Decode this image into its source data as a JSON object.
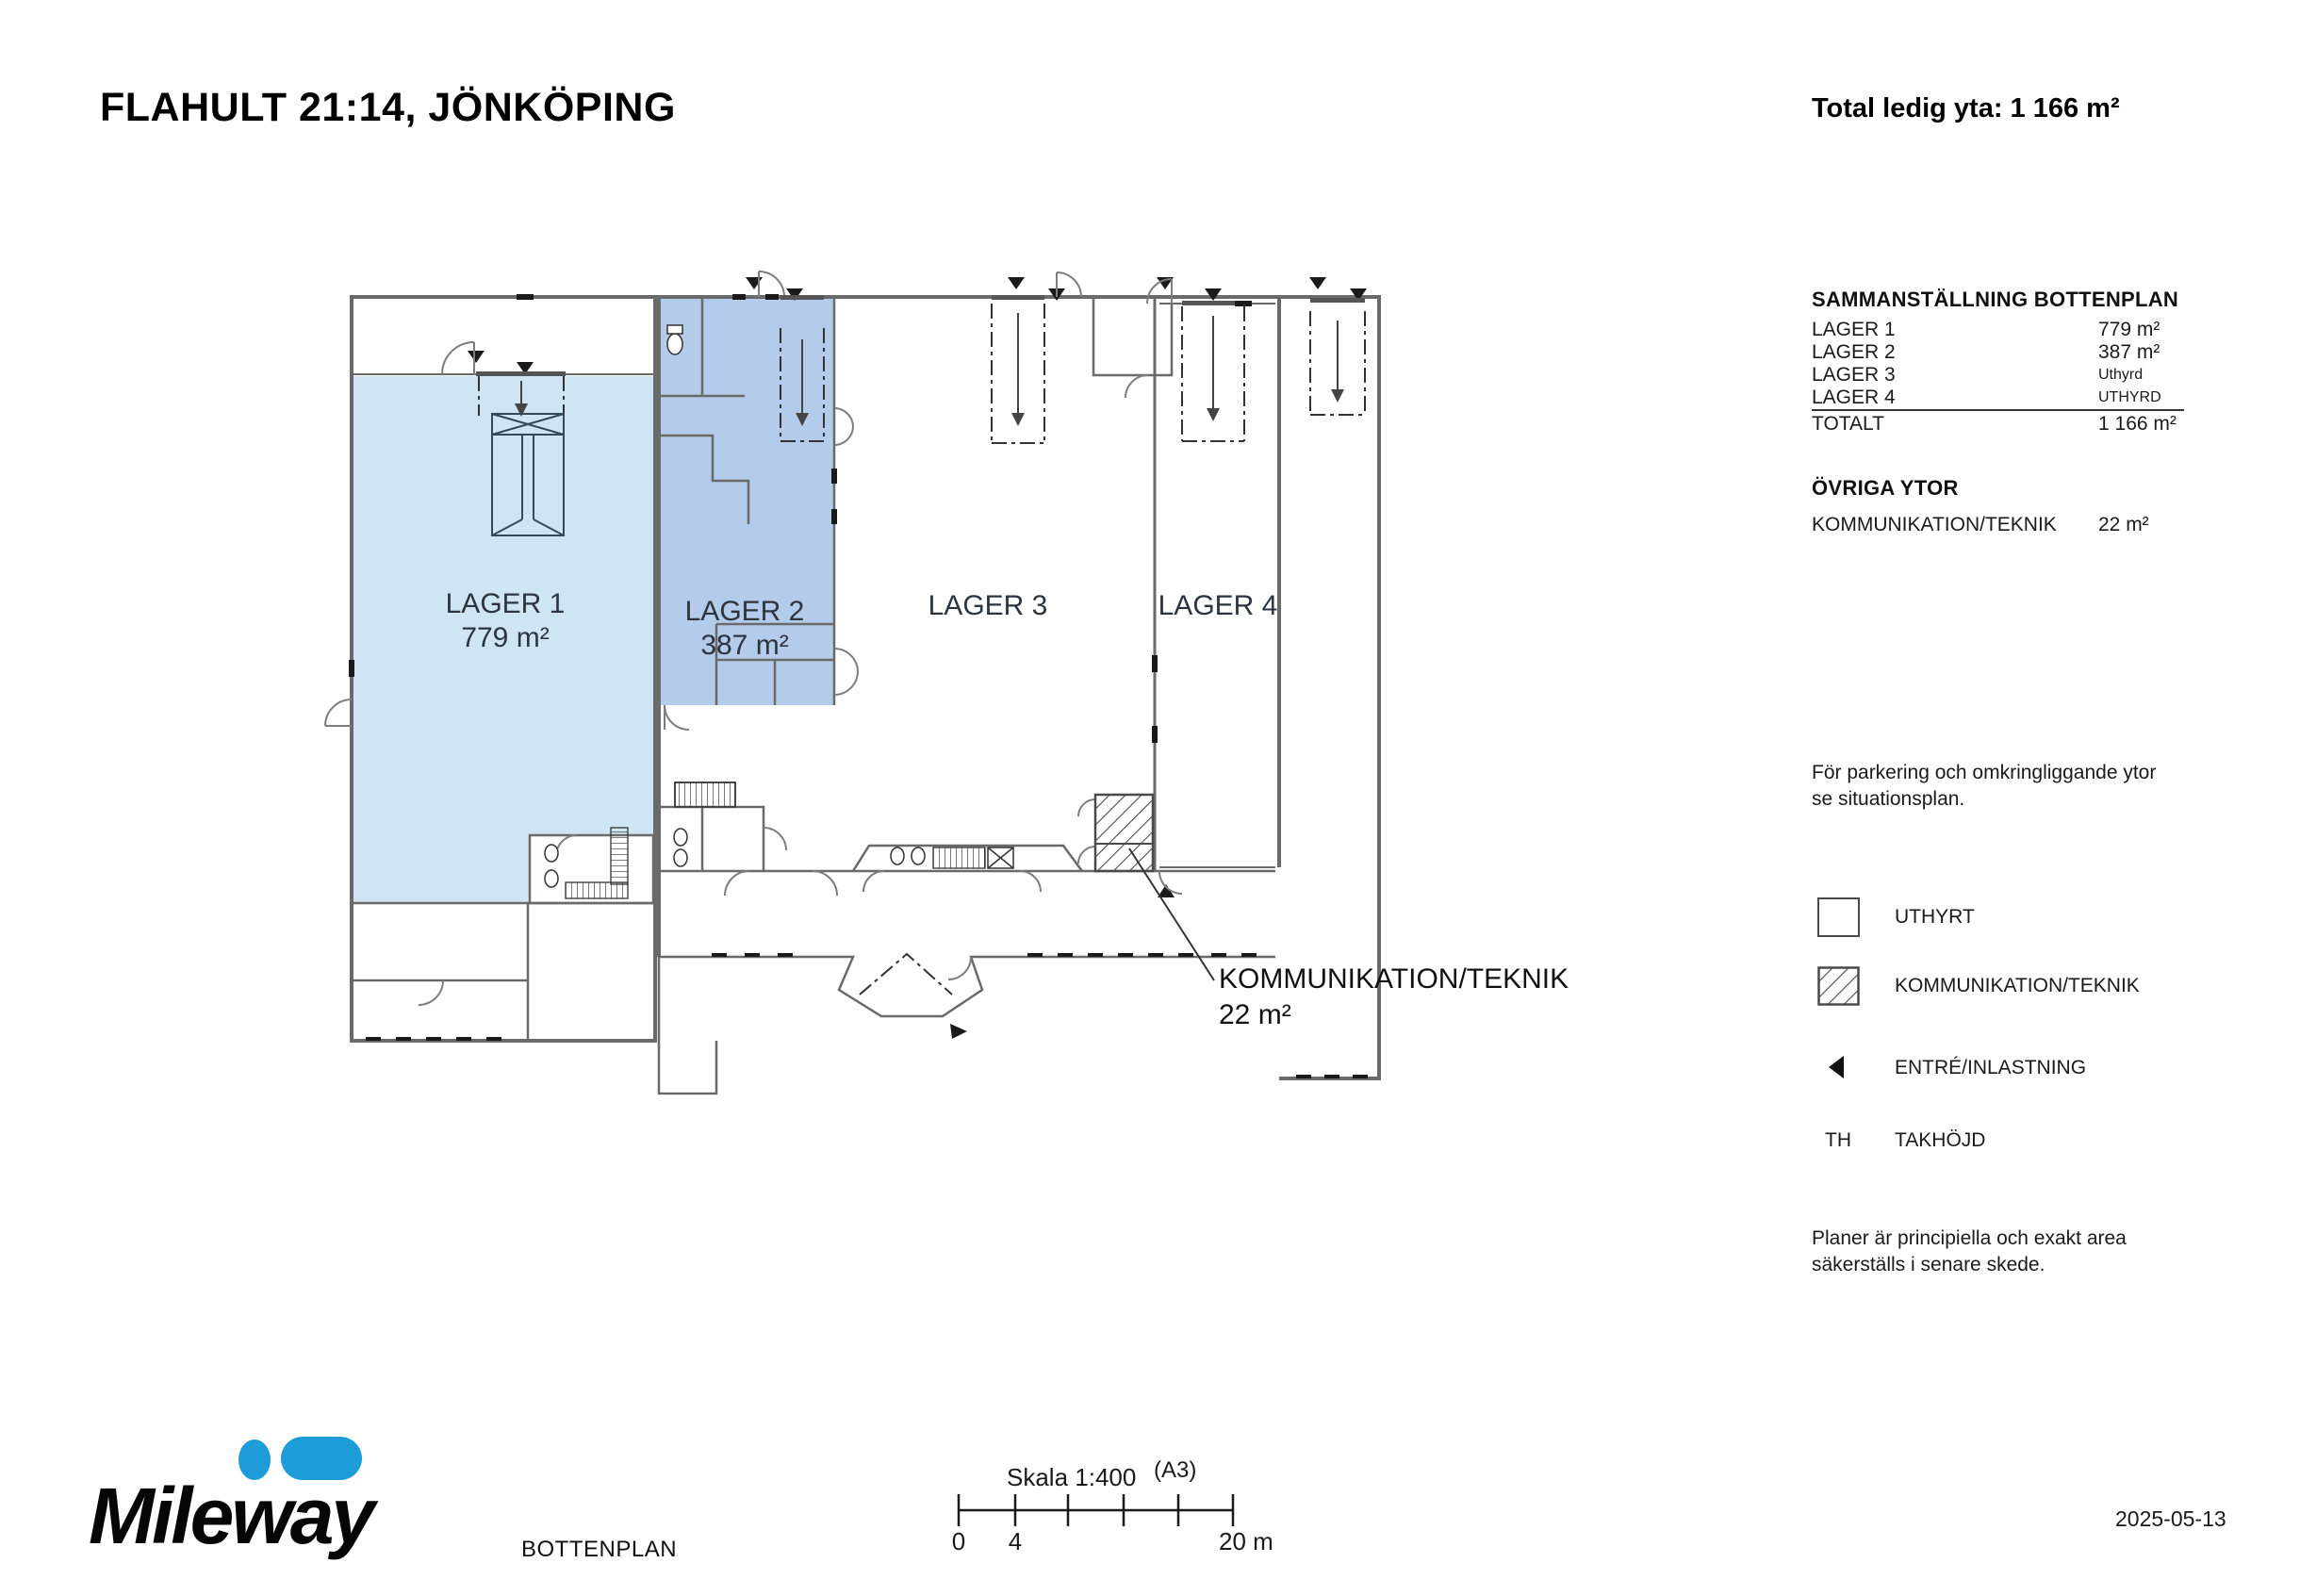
{
  "page": {
    "title": "FLAHULT 21:14, JÖNKÖPING",
    "total_area": "Total ledig yta: 1 166 m²",
    "date": "2025-05-13"
  },
  "summary": {
    "heading": "SAMMANSTÄLLNING BOTTENPLAN",
    "rows": [
      {
        "label": "LAGER 1",
        "value": "779 m²"
      },
      {
        "label": "LAGER 2",
        "value": "387 m²"
      },
      {
        "label": "LAGER 3",
        "value": "Uthyrd"
      },
      {
        "label": "LAGER 4",
        "value": "UTHYRD"
      }
    ],
    "total_label": "TOTALT",
    "total_value": "1 166 m²"
  },
  "other": {
    "heading": "ÖVRIGA YTOR",
    "label": "KOMMUNIKATION/TEKNIK",
    "value": "22 m²"
  },
  "notes": {
    "parking": "För parkering och omkringliggande ytor se situationsplan.",
    "disclaimer": "Planer är principiella och exakt area säkerställs i senare skede."
  },
  "legend": {
    "uthyrt": "UTHYRT",
    "kommunikation": "KOMMUNIKATION/TEKNIK",
    "entre": "ENTRÉ/INLASTNING",
    "th_abbr": "TH",
    "takhojd": "TAKHÖJD"
  },
  "plan": {
    "lager1": {
      "name": "LAGER 1",
      "area": "779 m²"
    },
    "lager2": {
      "name": "LAGER 2",
      "area": "387 m²"
    },
    "lager3": {
      "name": "LAGER 3"
    },
    "lager4": {
      "name": "LAGER 4"
    },
    "teknik": {
      "name": "KOMMUNIKATION/TEKNIK",
      "area": "22 m²"
    }
  },
  "footer": {
    "brand": "Mileway",
    "drawing_name": "BOTTENPLAN",
    "scale": "Skala 1:400",
    "paper": "(A3)",
    "tick_start": "0",
    "tick_4": "4",
    "tick_end": "20 m"
  },
  "colors": {
    "lager1_fill": "#cfe5f3",
    "lager2_fill": "#b3cce9",
    "brand_blue": "#1e9bd9"
  }
}
